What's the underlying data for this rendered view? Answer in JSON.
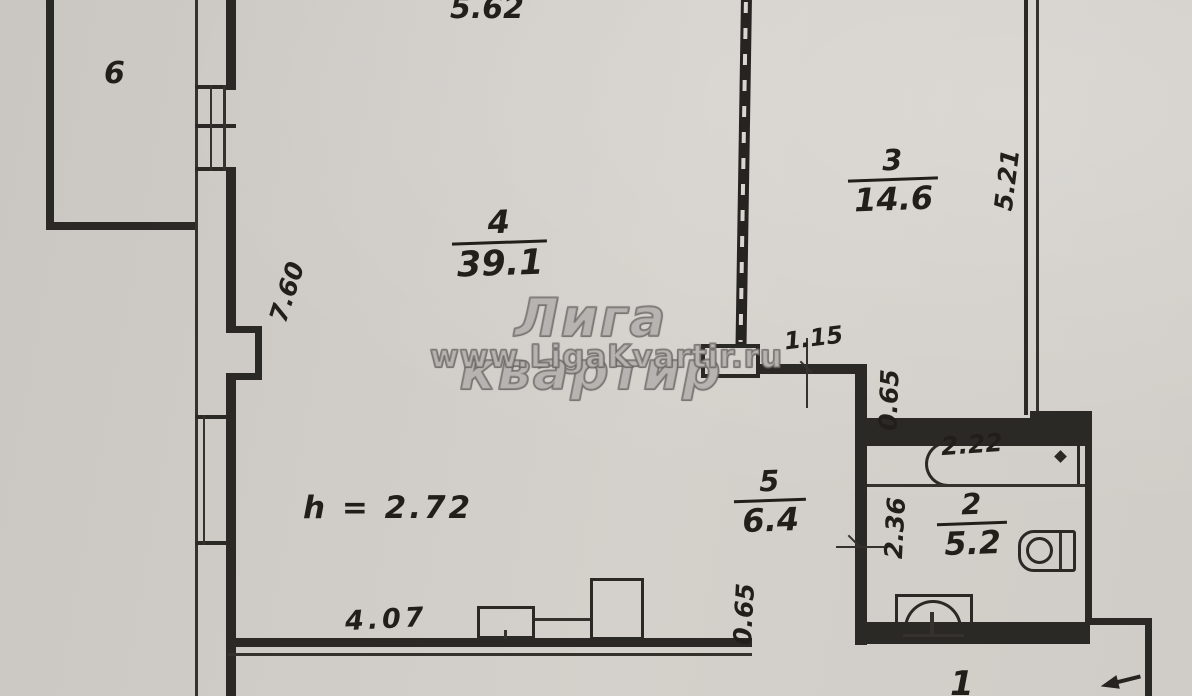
{
  "watermark": {
    "title": "Лига квартир",
    "url": "www.LigaKvartir.ru"
  },
  "ceiling_height": "h = 2.72",
  "rooms": {
    "r1": {
      "number": "1"
    },
    "r2": {
      "number": "2",
      "area": "5.2"
    },
    "r3": {
      "number": "3",
      "area": "14.6"
    },
    "r4": {
      "number": "4",
      "area": "39.1"
    },
    "r5": {
      "number": "5",
      "area": "6.4"
    },
    "r6": {
      "number": "6"
    }
  },
  "dimensions": {
    "top_wall_length": "5.62",
    "left_wall_length": "7.60",
    "right_wall_length": "5.21",
    "opening_width": "1.15",
    "wall_offset_upper": "0.65",
    "bath_wall_length": "2.36",
    "bathtub_length": "2.22",
    "bottom_wall_length": "4.07",
    "wall_offset_lower": "0.65"
  }
}
